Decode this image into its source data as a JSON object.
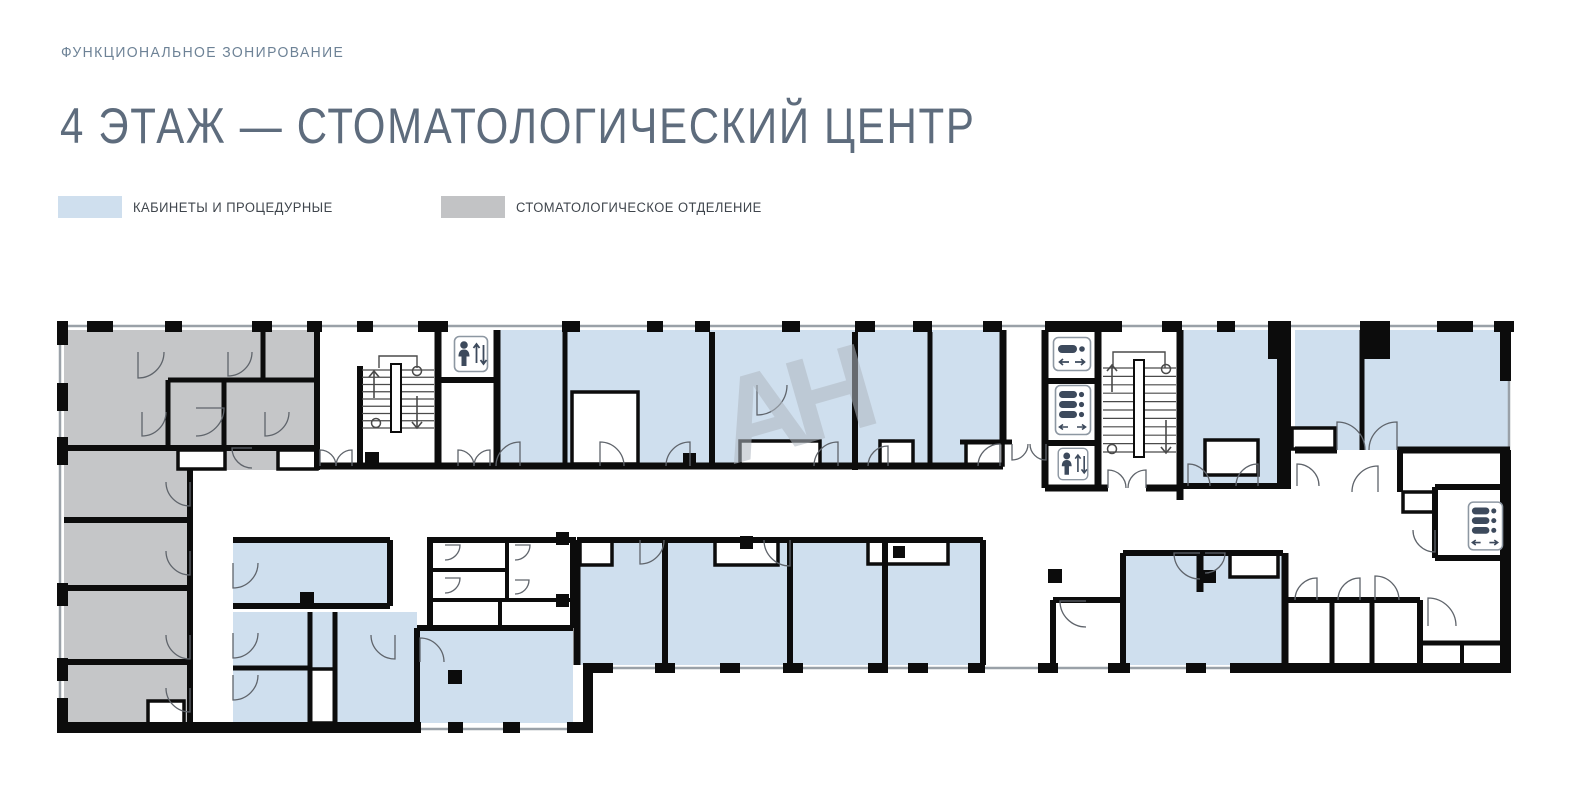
{
  "header": {
    "eyebrow": "ФУНКЦИОНАЛЬНОЕ ЗОНИРОВАНИЕ",
    "title": "4 ЭТАЖ — СТОМАТОЛОГИЧЕСКИЙ ЦЕНТР"
  },
  "legend": {
    "items": [
      {
        "label": "КАБИНЕТЫ И ПРОЦЕДУРНЫЕ",
        "color": "#cfdfee"
      },
      {
        "label": "СТОМАТОЛОГИЧЕСКОЕ ОТДЕЛЕНИЕ",
        "color": "#c2c3c5"
      }
    ]
  },
  "watermark": {
    "text": "АН"
  },
  "colors": {
    "eyebrow_text": "#6d8296",
    "title_text": "#5e6c7d",
    "legend_text": "#3f454c",
    "wall": "#0c0c0c",
    "window_line": "#9aa1a8",
    "cabinet_fill": "#cfdfee",
    "dental_fill": "#c5c6c8",
    "icon_ink": "#3d4a5c",
    "icon_border": "#8d97a2",
    "door_line": "#5f646b",
    "stair_line": "#4a4a4a",
    "watermark": "#b0b8c1"
  },
  "floor_plan": {
    "outline": [
      60,
      326,
      1509,
      326,
      1509,
      668,
      588,
      668,
      588,
      729,
      60,
      729
    ],
    "zones": {
      "dental": [
        [
          64,
          330,
          253,
          140
        ],
        [
          64,
          470,
          126,
          258
        ]
      ],
      "cabinet": [
        [
          497,
          330,
          506,
          136
        ],
        [
          1183,
          330,
          107,
          156
        ],
        [
          1295,
          330,
          215,
          120
        ],
        [
          233,
          540,
          157,
          66
        ],
        [
          233,
          612,
          184,
          111
        ],
        [
          417,
          628,
          156,
          95
        ],
        [
          577,
          540,
          406,
          125
        ],
        [
          1123,
          553,
          160,
          112
        ]
      ]
    },
    "notches": [
      [
        572,
        392,
        66,
        72
      ],
      [
        740,
        441,
        80,
        25
      ],
      [
        880,
        441,
        33,
        24
      ],
      [
        966,
        442,
        37,
        23
      ],
      [
        1205,
        440,
        53,
        35
      ],
      [
        1292,
        428,
        43,
        21
      ],
      [
        1230,
        553,
        48,
        24
      ],
      [
        580,
        540,
        32,
        25
      ],
      [
        715,
        540,
        63,
        25
      ],
      [
        868,
        540,
        80,
        24
      ],
      [
        1403,
        492,
        32,
        20
      ],
      [
        178,
        450,
        47,
        19
      ],
      [
        278,
        450,
        39,
        19
      ],
      [
        148,
        701,
        36,
        27
      ],
      [
        310,
        669,
        25,
        54
      ]
    ],
    "walls": [
      [
        64,
        448,
        317,
        448,
        6
      ],
      [
        317,
        330,
        317,
        470,
        6
      ],
      [
        190,
        470,
        190,
        727,
        6
      ],
      [
        64,
        520,
        190,
        520,
        6
      ],
      [
        64,
        588,
        190,
        588,
        6
      ],
      [
        64,
        662,
        190,
        662,
        6
      ],
      [
        168,
        380,
        317,
        380,
        5
      ],
      [
        168,
        380,
        168,
        448,
        5
      ],
      [
        224,
        380,
        224,
        448,
        5
      ],
      [
        263,
        332,
        263,
        380,
        5
      ],
      [
        318,
        466,
        497,
        466,
        7
      ],
      [
        360,
        366,
        360,
        468,
        6
      ],
      [
        438,
        332,
        438,
        466,
        7
      ],
      [
        438,
        380,
        497,
        380,
        6
      ],
      [
        497,
        330,
        497,
        466,
        7
      ],
      [
        497,
        466,
        1003,
        466,
        7
      ],
      [
        565,
        332,
        565,
        466,
        5
      ],
      [
        712,
        332,
        712,
        466,
        6
      ],
      [
        855,
        332,
        855,
        470,
        6
      ],
      [
        930,
        332,
        930,
        466,
        5
      ],
      [
        1003,
        330,
        1003,
        444,
        7
      ],
      [
        960,
        442,
        1012,
        442,
        5
      ],
      [
        1045,
        330,
        1045,
        488,
        7
      ],
      [
        1098,
        330,
        1098,
        488,
        7
      ],
      [
        1045,
        381,
        1098,
        381,
        6
      ],
      [
        1045,
        443,
        1098,
        443,
        6
      ],
      [
        1045,
        488,
        1108,
        488,
        7
      ],
      [
        1146,
        488,
        1180,
        488,
        7
      ],
      [
        1180,
        330,
        1180,
        500,
        7
      ],
      [
        1180,
        486,
        1290,
        486,
        6
      ],
      [
        1295,
        450,
        1337,
        450,
        7
      ],
      [
        1397,
        450,
        1510,
        450,
        7
      ],
      [
        1362,
        330,
        1362,
        450,
        5
      ],
      [
        1400,
        452,
        1400,
        492,
        6
      ],
      [
        1435,
        487,
        1510,
        487,
        6
      ],
      [
        1435,
        487,
        1435,
        558,
        6
      ],
      [
        1435,
        558,
        1510,
        558,
        6
      ],
      [
        1285,
        600,
        1420,
        600,
        6
      ],
      [
        1332,
        600,
        1332,
        665,
        5
      ],
      [
        1372,
        600,
        1372,
        665,
        5
      ],
      [
        1420,
        600,
        1420,
        665,
        6
      ],
      [
        1420,
        643,
        1510,
        643,
        5
      ],
      [
        1462,
        643,
        1462,
        665,
        4
      ],
      [
        1285,
        553,
        1285,
        665,
        7
      ],
      [
        1123,
        553,
        1283,
        553,
        6
      ],
      [
        1123,
        553,
        1123,
        665,
        6
      ],
      [
        1200,
        553,
        1200,
        592,
        7
      ],
      [
        233,
        540,
        390,
        540,
        6
      ],
      [
        390,
        540,
        390,
        606,
        6
      ],
      [
        233,
        606,
        390,
        606,
        6
      ],
      [
        233,
        668,
        310,
        668,
        5
      ],
      [
        310,
        612,
        310,
        723,
        5
      ],
      [
        335,
        612,
        335,
        723,
        5
      ],
      [
        417,
        628,
        417,
        723,
        6
      ],
      [
        417,
        628,
        573,
        628,
        6
      ],
      [
        430,
        537,
        430,
        628,
        6
      ],
      [
        573,
        537,
        573,
        628,
        6
      ],
      [
        430,
        540,
        573,
        540,
        6
      ],
      [
        507,
        540,
        507,
        600,
        4
      ],
      [
        430,
        570,
        507,
        570,
        4
      ],
      [
        430,
        600,
        573,
        600,
        4
      ],
      [
        500,
        600,
        500,
        628,
        4
      ],
      [
        577,
        540,
        983,
        540,
        6
      ],
      [
        577,
        540,
        577,
        665,
        7
      ],
      [
        665,
        540,
        665,
        665,
        6
      ],
      [
        790,
        540,
        790,
        665,
        6
      ],
      [
        885,
        540,
        885,
        665,
        6
      ],
      [
        983,
        540,
        983,
        665,
        6
      ],
      [
        1053,
        600,
        1053,
        665,
        6
      ],
      [
        1053,
        600,
        1123,
        600,
        6
      ]
    ],
    "piers": [
      [
        87,
        321,
        26,
        11
      ],
      [
        165,
        321,
        17,
        11
      ],
      [
        252,
        321,
        20,
        11
      ],
      [
        307,
        321,
        15,
        11
      ],
      [
        357,
        321,
        16,
        11
      ],
      [
        418,
        321,
        30,
        11
      ],
      [
        562,
        321,
        18,
        11
      ],
      [
        647,
        321,
        16,
        11
      ],
      [
        695,
        321,
        15,
        11
      ],
      [
        782,
        321,
        18,
        11
      ],
      [
        855,
        321,
        20,
        11
      ],
      [
        913,
        321,
        19,
        11
      ],
      [
        983,
        321,
        19,
        11
      ],
      [
        1045,
        321,
        77,
        11
      ],
      [
        1162,
        321,
        20,
        11
      ],
      [
        1217,
        321,
        18,
        11
      ],
      [
        1268,
        321,
        22,
        38
      ],
      [
        1360,
        321,
        30,
        38
      ],
      [
        1437,
        321,
        36,
        11
      ],
      [
        1494,
        321,
        20,
        11
      ],
      [
        1500,
        321,
        11,
        60
      ],
      [
        1500,
        450,
        11,
        220
      ],
      [
        655,
        663,
        20,
        10
      ],
      [
        720,
        663,
        20,
        10
      ],
      [
        783,
        663,
        20,
        10
      ],
      [
        868,
        663,
        20,
        10
      ],
      [
        908,
        663,
        20,
        10
      ],
      [
        968,
        663,
        17,
        10
      ],
      [
        1038,
        663,
        20,
        10
      ],
      [
        1108,
        663,
        22,
        10
      ],
      [
        1186,
        663,
        20,
        10
      ],
      [
        1230,
        663,
        281,
        10
      ],
      [
        585,
        663,
        28,
        10
      ],
      [
        583,
        663,
        10,
        70
      ],
      [
        57,
        722,
        364,
        11
      ],
      [
        448,
        722,
        15,
        11
      ],
      [
        503,
        722,
        17,
        11
      ],
      [
        567,
        722,
        21,
        11
      ],
      [
        57,
        321,
        11,
        24
      ],
      [
        57,
        383,
        11,
        28
      ],
      [
        57,
        437,
        11,
        28
      ],
      [
        57,
        583,
        11,
        23
      ],
      [
        57,
        658,
        11,
        23
      ],
      [
        57,
        698,
        11,
        35
      ],
      [
        1277,
        321,
        14,
        168
      ],
      [
        365,
        452,
        14,
        14
      ],
      [
        740,
        536,
        13,
        13
      ],
      [
        893,
        546,
        12,
        12
      ],
      [
        1048,
        569,
        14,
        14
      ],
      [
        300,
        592,
        14,
        14
      ],
      [
        448,
        670,
        14,
        14
      ],
      [
        556,
        532,
        13,
        13
      ],
      [
        556,
        594,
        13,
        13
      ],
      [
        1203,
        570,
        13,
        13
      ],
      [
        683,
        453,
        13,
        13
      ]
    ],
    "doors": [
      [
        138,
        352,
        26,
        90,
        0
      ],
      [
        228,
        352,
        24,
        90,
        0
      ],
      [
        196,
        408,
        28,
        0,
        90
      ],
      [
        142,
        412,
        24,
        90,
        0
      ],
      [
        265,
        412,
        24,
        90,
        0
      ],
      [
        252,
        448,
        20,
        180,
        90
      ],
      [
        320,
        466,
        16,
        270,
        360
      ],
      [
        352,
        466,
        16,
        270,
        180
      ],
      [
        458,
        466,
        16,
        270,
        360
      ],
      [
        490,
        466,
        16,
        270,
        180
      ],
      [
        520,
        466,
        24,
        270,
        180
      ],
      [
        600,
        466,
        24,
        270,
        360
      ],
      [
        690,
        466,
        24,
        270,
        180
      ],
      [
        757,
        385,
        30,
        90,
        0
      ],
      [
        838,
        466,
        24,
        270,
        180
      ],
      [
        888,
        466,
        20,
        270,
        180
      ],
      [
        1000,
        466,
        22,
        270,
        180
      ],
      [
        1012,
        444,
        16,
        90,
        0
      ],
      [
        1046,
        444,
        16,
        90,
        180
      ],
      [
        1108,
        488,
        18,
        270,
        360
      ],
      [
        1146,
        488,
        18,
        270,
        180
      ],
      [
        1188,
        486,
        22,
        270,
        360
      ],
      [
        1258,
        486,
        22,
        270,
        180
      ],
      [
        1297,
        486,
        22,
        270,
        360
      ],
      [
        1337,
        450,
        28,
        270,
        360
      ],
      [
        1397,
        450,
        28,
        270,
        180
      ],
      [
        1378,
        492,
        26,
        270,
        180
      ],
      [
        190,
        482,
        24,
        90,
        180
      ],
      [
        190,
        551,
        24,
        90,
        180
      ],
      [
        190,
        635,
        24,
        90,
        180
      ],
      [
        190,
        688,
        24,
        90,
        180
      ],
      [
        233,
        563,
        25,
        90,
        0
      ],
      [
        233,
        633,
        25,
        90,
        0
      ],
      [
        233,
        675,
        25,
        90,
        0
      ],
      [
        445,
        545,
        15,
        0,
        90
      ],
      [
        445,
        578,
        15,
        0,
        90
      ],
      [
        515,
        545,
        15,
        0,
        90
      ],
      [
        515,
        580,
        14,
        0,
        90
      ],
      [
        420,
        662,
        24,
        270,
        360
      ],
      [
        395,
        635,
        24,
        90,
        180
      ],
      [
        640,
        540,
        24,
        90,
        0
      ],
      [
        790,
        540,
        26,
        90,
        180
      ],
      [
        1086,
        601,
        26,
        180,
        90
      ],
      [
        1200,
        553,
        26,
        180,
        90
      ],
      [
        1205,
        553,
        20,
        0,
        90
      ],
      [
        1317,
        600,
        22,
        270,
        180
      ],
      [
        1360,
        600,
        22,
        270,
        180
      ],
      [
        1375,
        600,
        24,
        270,
        360
      ],
      [
        1435,
        530,
        22,
        90,
        180
      ],
      [
        1428,
        626,
        28,
        270,
        0
      ]
    ],
    "stairs": [
      {
        "x": 362,
        "w": 72,
        "y": 370,
        "h": 58,
        "steps": 8,
        "bar": [
          391,
          364,
          10,
          68
        ],
        "landing": [
          379,
          368,
          379,
          356,
          417,
          356,
          417,
          368
        ],
        "up": [
          374,
          398,
          374,
          371
        ],
        "down": [
          417,
          396,
          417,
          428
        ],
        "circles": [
          [
            417,
            371
          ],
          [
            376,
            423
          ]
        ]
      },
      {
        "x": 1103,
        "w": 73,
        "y": 368,
        "h": 84,
        "steps": 10,
        "bar": [
          1134,
          360,
          10,
          97
        ],
        "landing": [
          1113,
          368,
          1113,
          352,
          1165,
          352,
          1165,
          368
        ],
        "up": [
          1112,
          392,
          1112,
          365
        ],
        "down": [
          1166,
          420,
          1166,
          453
        ],
        "circles": [
          [
            1166,
            369
          ],
          [
            1112,
            449
          ]
        ]
      }
    ],
    "elevators": [
      {
        "type": "passenger",
        "x": 453,
        "y": 335,
        "w": 36,
        "h": 38
      },
      {
        "type": "bed",
        "x": 1052,
        "y": 336,
        "w": 40,
        "h": 36
      },
      {
        "type": "bed2",
        "x": 1054,
        "y": 384,
        "w": 38,
        "h": 52
      },
      {
        "type": "passenger",
        "x": 1056,
        "y": 447,
        "w": 34,
        "h": 34
      },
      {
        "type": "bed2",
        "x": 1467,
        "y": 499,
        "w": 37,
        "h": 54
      }
    ]
  }
}
